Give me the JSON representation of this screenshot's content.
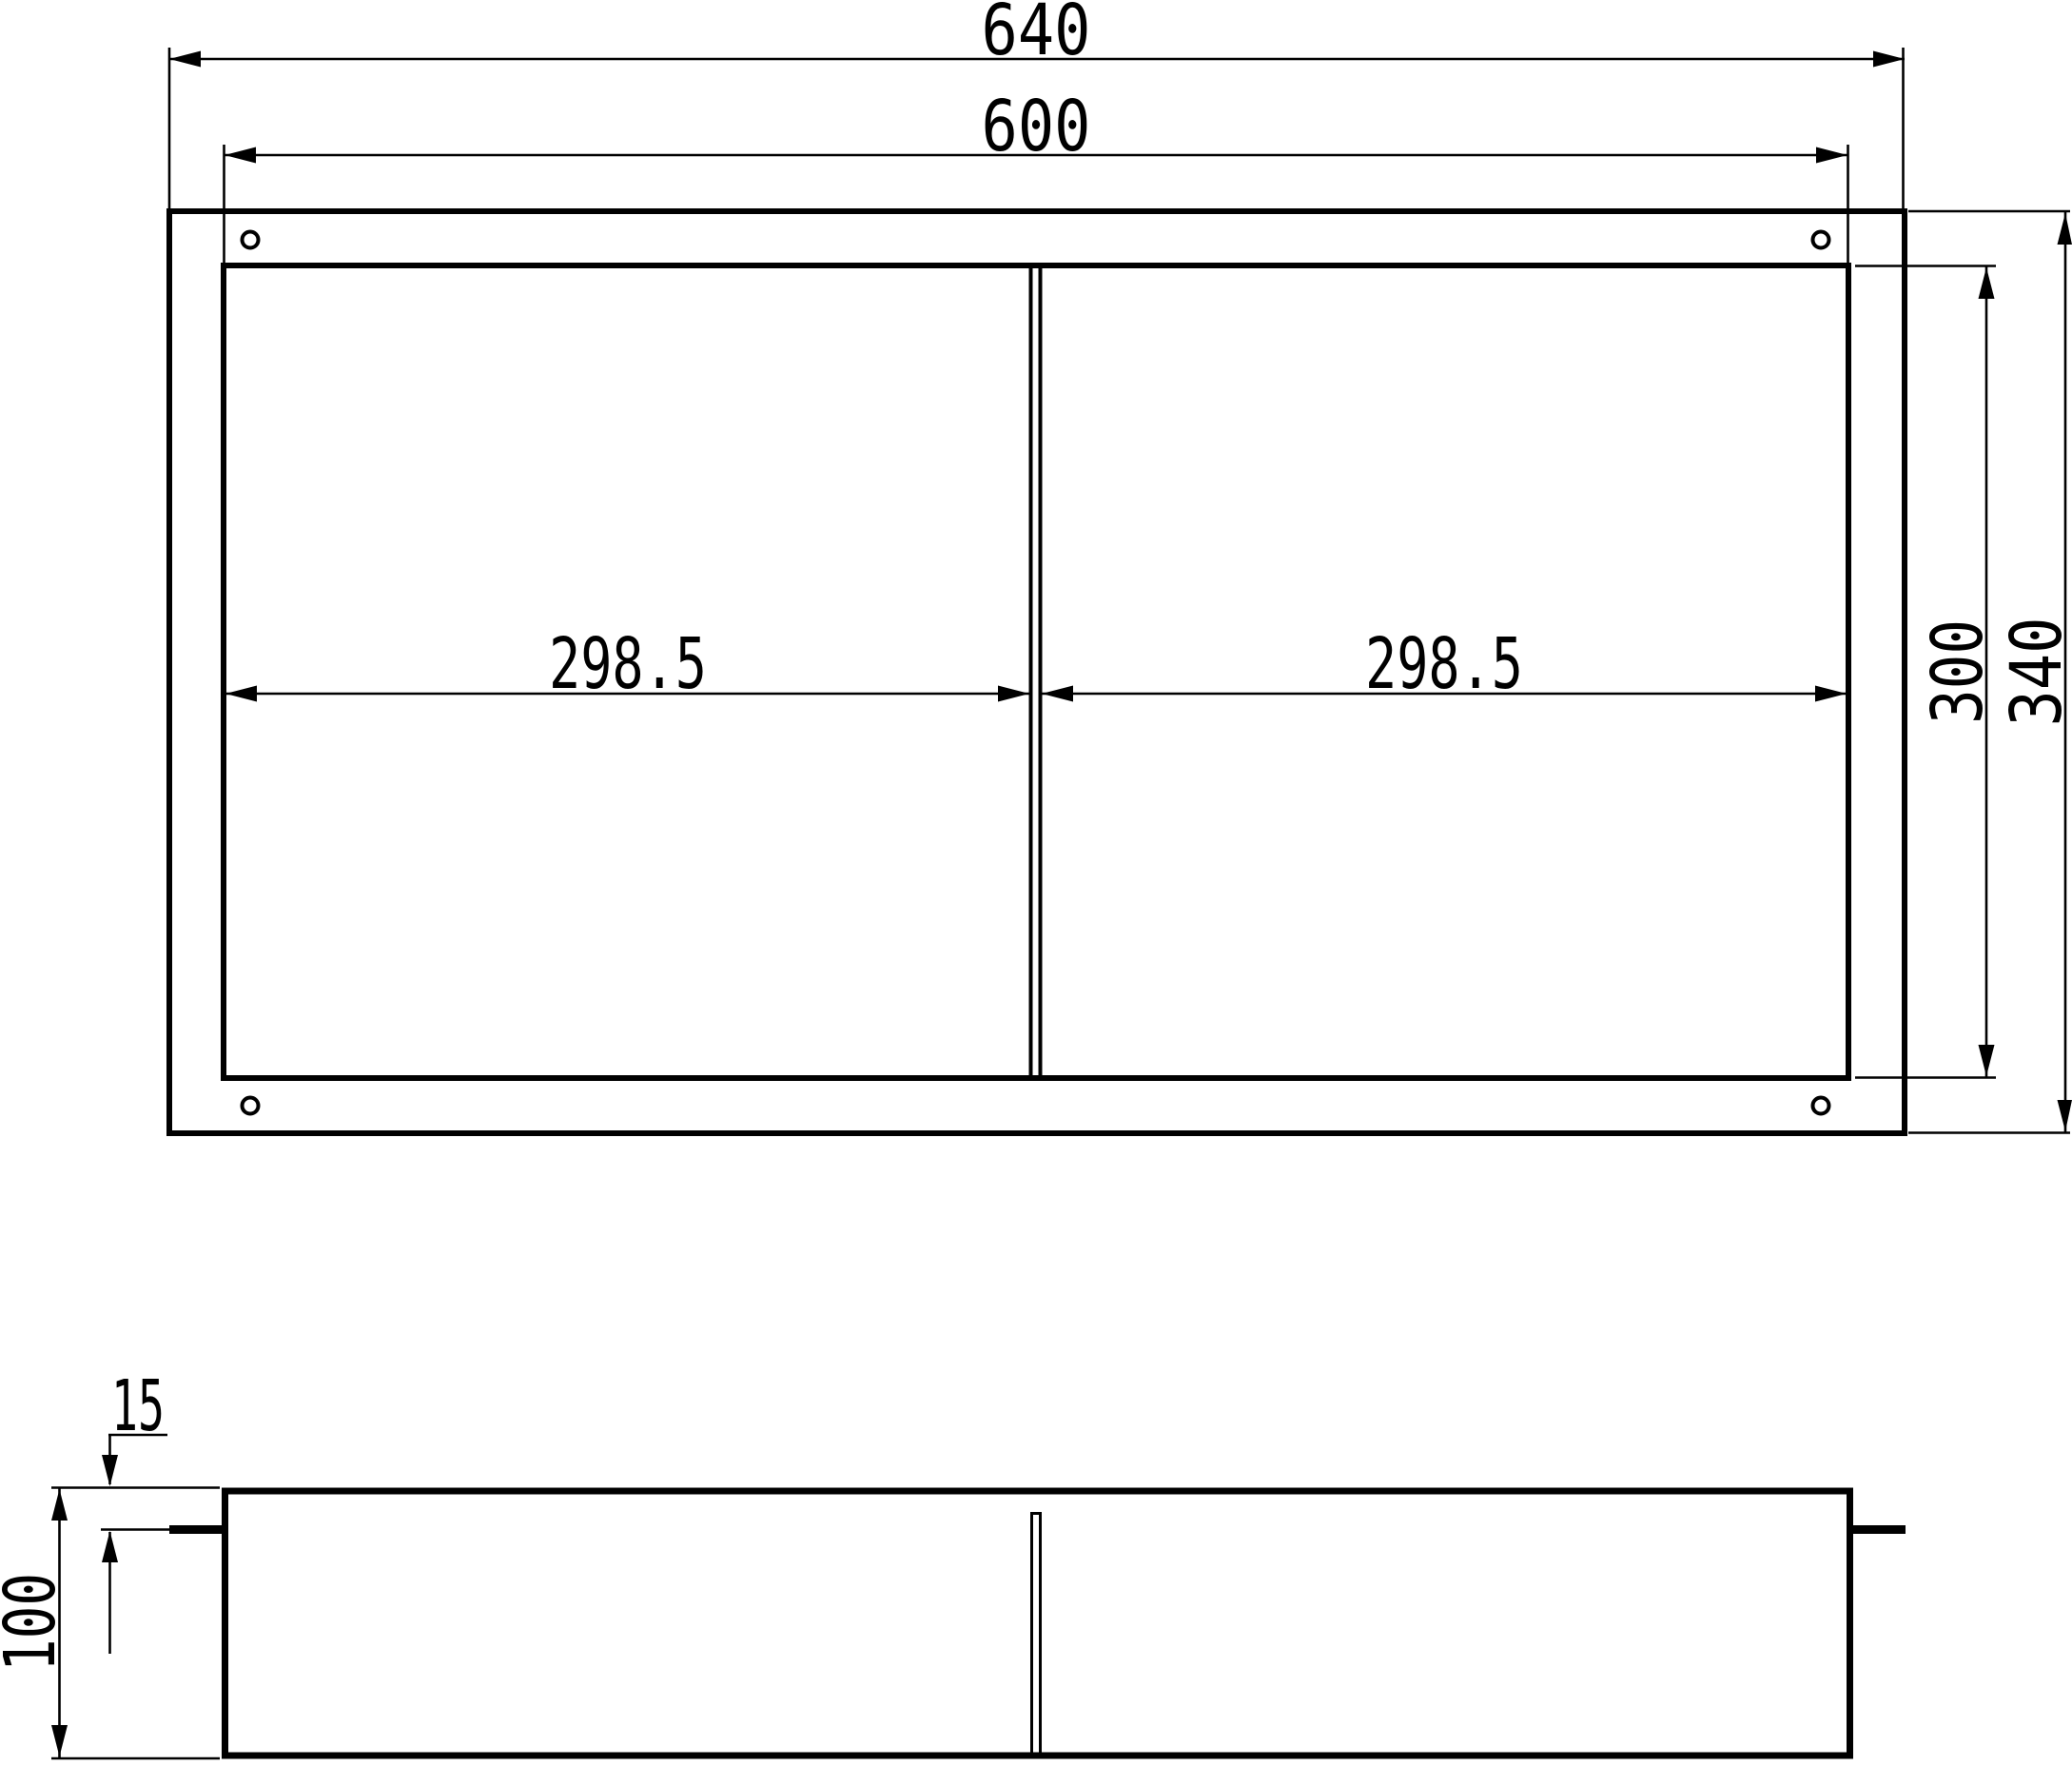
{
  "drawing": {
    "colors": {
      "line": "#000000",
      "background": "#ffffff"
    },
    "front_view": {
      "outer_width_label": "640",
      "opening_width_label": "600",
      "left_compartment_width_label": "298.5",
      "right_compartment_width_label": "298.5",
      "opening_height_label": "300",
      "outer_height_label": "340"
    },
    "section_view": {
      "flange_offset_label": "15",
      "depth_label": "100"
    }
  }
}
